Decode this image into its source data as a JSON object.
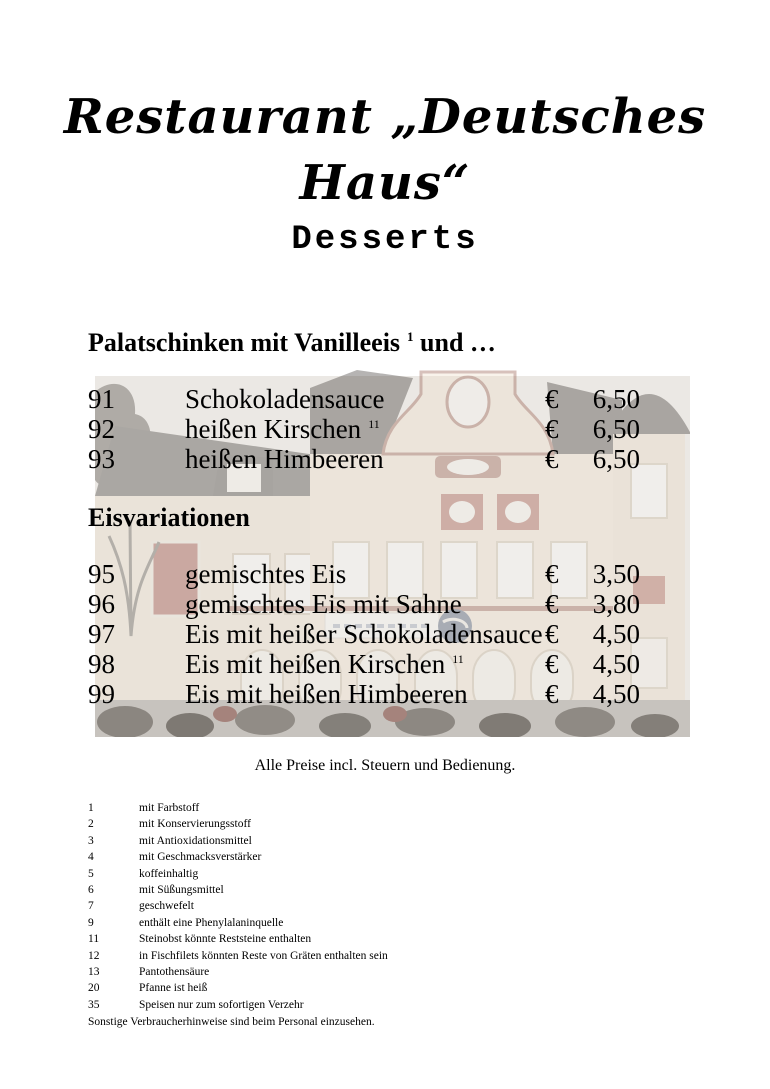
{
  "page": {
    "title": "Restaurant „Deutsches Haus“",
    "heading": "Desserts",
    "note": "Alle Preise incl. Steuern und Bedienung.",
    "footnotes_closing": "Sonstige Verbraucherhinweise sind beim Personal einzusehen."
  },
  "photo": {
    "alt": "Faded photograph of the restaurant building Deutsches Haus"
  },
  "colors": {
    "text": "#000000",
    "photo_roof_wash": "#a8a5a1",
    "photo_wall_wash": "#ece4d8",
    "photo_red_wash": "#c5a49c"
  },
  "menu": {
    "currency": "€",
    "sections": [
      {
        "heading": "Palatschinken mit Vanilleeis",
        "heading_sup": "1",
        "heading_suffix": " und …",
        "items": [
          {
            "num": "91",
            "name": "Schokoladensauce",
            "sup": "",
            "price": "6,50"
          },
          {
            "num": "92",
            "name": "heißen Kirschen",
            "sup": "11",
            "price": "6,50"
          },
          {
            "num": "93",
            "name": "heißen Himbeeren",
            "sup": "",
            "price": "6,50"
          }
        ]
      },
      {
        "heading": "Eisvariationen",
        "heading_sup": "",
        "heading_suffix": "",
        "items": [
          {
            "num": "95",
            "name": "gemischtes Eis",
            "sup": "",
            "price": "3,50"
          },
          {
            "num": "96",
            "name": "gemischtes Eis mit Sahne",
            "sup": "",
            "price": "3,80"
          },
          {
            "num": "97",
            "name": "Eis mit heißer Schokoladensauce",
            "sup": "",
            "price": "4,50"
          },
          {
            "num": "98",
            "name": "Eis mit heißen Kirschen",
            "sup": "11",
            "price": "4,50"
          },
          {
            "num": "99",
            "name": "Eis mit heißen Himbeeren",
            "sup": "",
            "price": "4,50"
          }
        ]
      }
    ]
  },
  "footnotes": [
    {
      "num": "1",
      "text": "mit Farbstoff"
    },
    {
      "num": "2",
      "text": "mit Konservierungsstoff"
    },
    {
      "num": "3",
      "text": "mit Antioxidationsmittel"
    },
    {
      "num": "4",
      "text": "mit Geschmacksverstärker"
    },
    {
      "num": "5",
      "text": "koffeinhaltig"
    },
    {
      "num": "6",
      "text": "mit Süßungsmittel"
    },
    {
      "num": "7",
      "text": "geschwefelt"
    },
    {
      "num": "9",
      "text": "enthält eine Phenylalaninquelle"
    },
    {
      "num": "11",
      "text": "Steinobst könnte Reststeine enthalten"
    },
    {
      "num": "12",
      "text": "in Fischfilets könnten Reste von Gräten enthalten sein"
    },
    {
      "num": "13",
      "text": "Pantothensäure"
    },
    {
      "num": "20",
      "text": "Pfanne ist heiß"
    },
    {
      "num": "35",
      "text": "Speisen nur zum sofortigen Verzehr"
    }
  ]
}
